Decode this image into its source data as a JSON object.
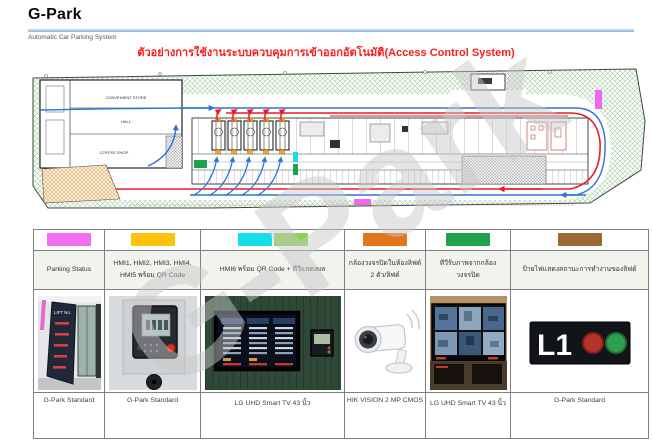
{
  "header": {
    "brand": "G-Park",
    "subtitle": "Automatic Car Parking System"
  },
  "title": "ตัวอย่างการใช้งานระบบควบคุมการเข้าออกอัตโนมัติ(Access Control System)",
  "watermark": "G-Park",
  "plan": {
    "labels": {
      "convenient_store": "CONVENIENT STORE",
      "hall": "HALL",
      "coffee_shop": "COFFEE SHOP"
    },
    "colors": {
      "route_entry": "#2e74d8",
      "route_exit": "#ec1c24",
      "lift_marker": "#f5a22b",
      "status_magenta": "#f266f2",
      "cam_cyan": "#16dde8",
      "tv_green": "#1fa24c",
      "landscape_green": "#8fbc8f"
    }
  },
  "legend": {
    "columns": [
      {
        "swatches": [
          "#f06ff0"
        ],
        "label": "Parking Status",
        "caption": "G-Park Standard"
      },
      {
        "swatches": [
          "#fdc10e"
        ],
        "label": "HMI1, HMI2, HMI3, HMI4, HMI5 พร้อม QR Code",
        "caption": "G-Park Standard"
      },
      {
        "swatches": [
          "#16dde8",
          "#8ed054"
        ],
        "label": "HMI6 พร้อม QR Code + ทีวีแสดงผล",
        "caption": "LG UHD Smart TV 43 นิ้ว"
      },
      {
        "swatches": [
          "#e2761b"
        ],
        "label": "กล้องวงจรปิดในห้องลิฟต์ 2 ตัว/ลิฟต์",
        "caption": "HIK VISION 2 MP CMOS"
      },
      {
        "swatches": [
          "#1fa24c"
        ],
        "label": "ทีวีรับภาพจากกล้องวงจรปิด",
        "caption": "LG UHD Smart TV 43 นิ้ว"
      },
      {
        "swatches": [
          "#9a6a33"
        ],
        "label": "ป้ายไฟแสดงสถานะการทำงานของลิฟต์",
        "caption": "G-Park Standard"
      }
    ]
  },
  "photos": {
    "l1_text": "L1",
    "lift_board_title": "LIFT No."
  }
}
